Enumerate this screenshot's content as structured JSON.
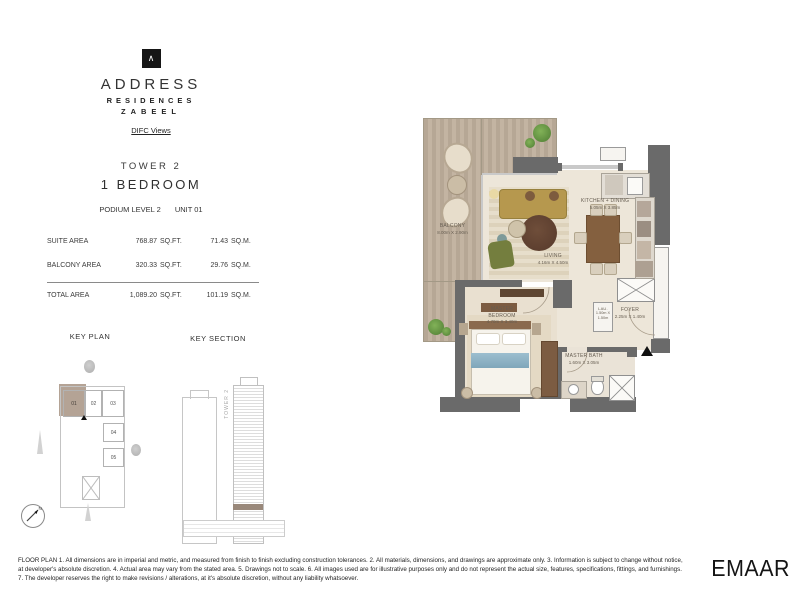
{
  "colors": {
    "wall_dark": "#6a6a6a",
    "deck_wood": "#b6a795",
    "floor_cream": "#ede6d9",
    "unit_highlight": "#b4a395",
    "sofa": "#b6984e",
    "bed_runner": "#8fb3c4",
    "section_highlight": "#99887a"
  },
  "brand": {
    "logo_glyph": "∧",
    "line1": "ADDRESS",
    "line2": "RESIDENCES",
    "line3": "ZABEEL",
    "views_label": "DIFC Views"
  },
  "unit": {
    "tower": "TOWER 2",
    "type": "1 BEDROOM",
    "level": "PODIUM LEVEL 2",
    "number": "UNIT 01"
  },
  "areas": {
    "rows": [
      {
        "label": "SUITE AREA",
        "sqft": "768.87",
        "sqft_unit": "SQ.FT.",
        "sqm": "71.43",
        "sqm_unit": "SQ.M."
      },
      {
        "label": "BALCONY AREA",
        "sqft": "320.33",
        "sqft_unit": "SQ.FT.",
        "sqm": "29.76",
        "sqm_unit": "SQ.M."
      },
      {
        "label": "TOTAL AREA",
        "sqft": "1,089.20",
        "sqft_unit": "SQ.FT.",
        "sqm": "101.19",
        "sqm_unit": "SQ.M."
      }
    ]
  },
  "key_plan": {
    "title": "KEY PLAN",
    "units": [
      {
        "id": "01"
      },
      {
        "id": "02"
      },
      {
        "id": "03"
      },
      {
        "id": "04"
      },
      {
        "id": "05"
      }
    ]
  },
  "key_section": {
    "title": "KEY SECTION",
    "tower_label": "TOWER 2"
  },
  "plan": {
    "rooms": {
      "balcony": {
        "name": "BALCONY",
        "dims": "8.00m X 2.90m"
      },
      "living": {
        "name": "LIVING",
        "dims": "4.16m X 4.50m"
      },
      "kitchen": {
        "name": "KITCHEN + DINING",
        "dims": "5.05m X 3.85m"
      },
      "bedroom": {
        "name": "MASTER BEDROOM",
        "dims": "4.70m X 3.40m"
      },
      "bath": {
        "name": "MASTER BATH",
        "dims": "1.60m X 3.05m"
      },
      "foyer": {
        "name": "FOYER",
        "dims": "2.25m X 1.40m"
      },
      "laundry": {
        "name": "LAU.",
        "dims": "1.50m X 1.50m"
      }
    }
  },
  "footer": {
    "line1": "FLOOR PLAN 1. All dimensions are in imperial and metric, and measured from finish to finish excluding construction tolerances. 2. All materials, dimensions, and drawings are approximate only. 3. Information is subject to change without  notice,",
    "line2": "at developer's absolute discretion. 4. Actual area may vary from the stated area. 5. Drawings not to scale. 6. All images used are for illustrative purposes only and do not represent the actual size, features, specifications, fittings, and furnishings.",
    "line3": "7. The developer reserves the right to make revisions / alterations, at it's absolute discretion, without any liability whatsoever.",
    "emaar_logo": "EMAAR"
  }
}
